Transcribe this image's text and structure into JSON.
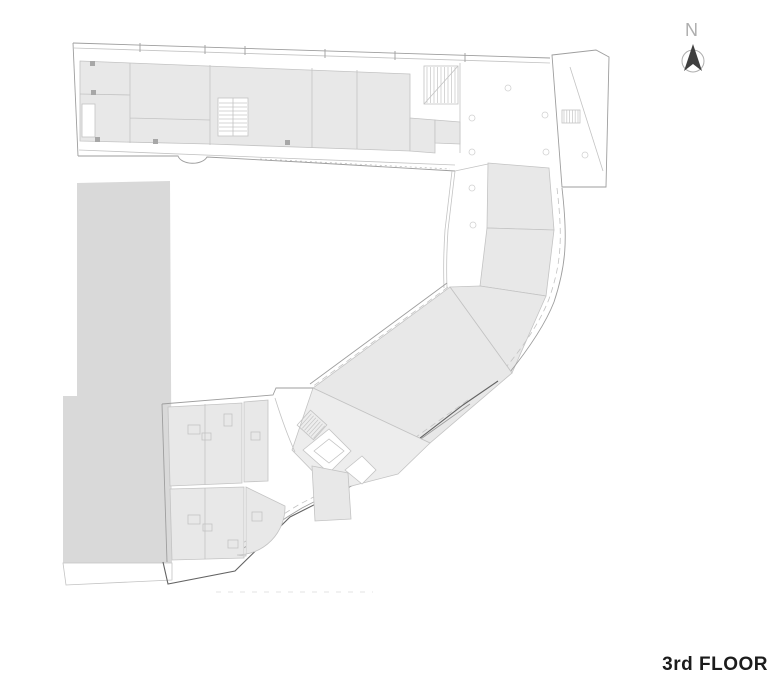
{
  "compass": {
    "label": "N"
  },
  "title": {
    "floor_label": "3rd FLOOR"
  },
  "theme": {
    "background": "#ffffff",
    "room_fill": "#e8e8e8",
    "room_fill_light": "#ededed",
    "mass_fill": "#d9d9d9",
    "line_light": "#c3c3c3",
    "line_medium": "#9e9e9e",
    "line_dark": "#636363",
    "hatch": "#c6c6c6",
    "column_marker": "#a7a7a7",
    "compass": "#aeaeae",
    "needle": "#3f3f3f",
    "title_text": "#1c1c1c"
  }
}
